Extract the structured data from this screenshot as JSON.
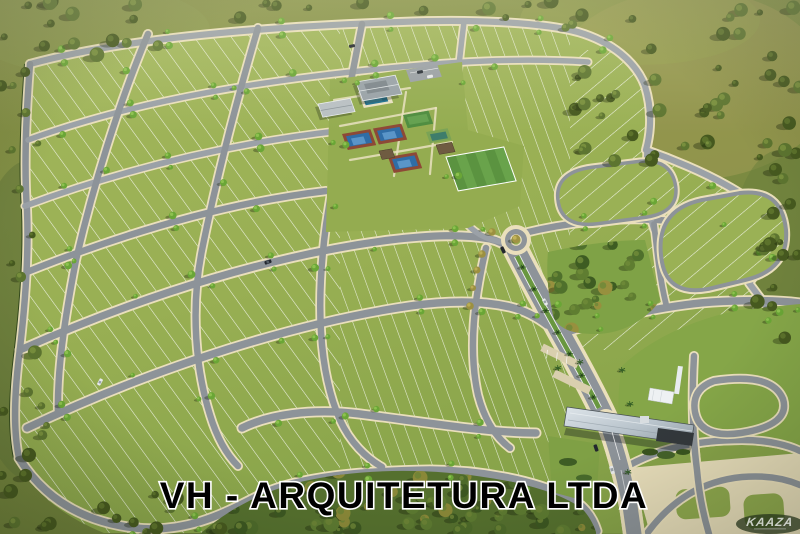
{
  "meta": {
    "description": "Aerial 3D architectural rendering of a gated residential land development (loteamento) with lot blocks, tree-lined streets, central clubhouse with sports courts and pool, roundabout, palm-lined boulevard and entrance gatehouse"
  },
  "caption": {
    "text": "VH - ARQUITETURA LTDA"
  },
  "watermark": {
    "text": "KAAZA"
  },
  "colors": {
    "outside_grass": "#7d8c42",
    "outside_gold": "#a09a52",
    "site_grass": "#98af53",
    "road": "#8d9399",
    "road_far": "#9ba1a7",
    "sidewalk": "#eadfbc",
    "lot_line": "#ffffff",
    "hedge": "#33491d",
    "street_tree": "#6aa636",
    "wild_tree": "#46591f",
    "forest_dark": "#55702e",
    "pool_water": "#1d6f90",
    "pool_deck": "#e9e1c3",
    "tennis_blue": "#2f6da6",
    "tennis_inner": "#5a95c8",
    "court_red": "#8d4936",
    "sport_green": "#4e8c3f",
    "futsal_green": "#3e7d6b",
    "field_green_a": "#5b9340",
    "field_green_b": "#69a34b",
    "clubhouse_roof": "#99a2a8",
    "annex_roof": "#b9c0c4",
    "pavilion_roof": "#6f5b41",
    "gate_roof_dark": "#33383c",
    "median_green": "#69973f",
    "plaza_cream": "#e7ddba",
    "park_lawn": "#7fa246",
    "caption_fill": "#000000",
    "caption_stroke": "#ffffff",
    "car_dark": "#23272e",
    "car_white": "#e8eaec"
  }
}
